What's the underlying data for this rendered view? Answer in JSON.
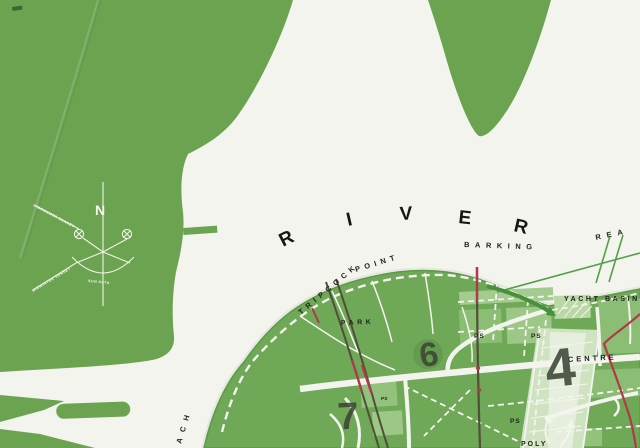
{
  "map_type": "planning-map-scan",
  "colors": {
    "land_green": "#6ba351",
    "land_green_south": "#6fa857",
    "paper_white": "#f3f4ee",
    "parcel_light": "#9cc583",
    "parcel_pale": "#cfe3c1",
    "parcel_palest": "#e6efdd",
    "route_dark_olive": "#514f39",
    "route_crimson": "#b03a4a",
    "route_green": "#55a04a",
    "label_ink": "#20251e",
    "compass_white": "#f6f8f0"
  },
  "river": {
    "letters": [
      "R",
      "I",
      "V",
      "E",
      "R"
    ],
    "reach_word": "BARKING",
    "reach_continuation": "REA",
    "left_reach_fragment": "ACH"
  },
  "shore": {
    "point_word1": "TRIPCOCK",
    "point_word2": "POINT"
  },
  "labels": {
    "park": "PARK",
    "yacht_basin": "YACHT BASIN",
    "centre": "CENTRE",
    "poly": "POLY",
    "ps_a": "PS",
    "ps_b": "PS",
    "ps_c": "PS",
    "ps_small": "PS"
  },
  "numbers": {
    "six": "6",
    "four": "4",
    "seven": "7"
  },
  "compass": {
    "north": "N",
    "upper_ray": "MIDSUMMER SUNSET",
    "lower_ray": "MIDWINTER SUNSET",
    "arc": "SUN PATH"
  }
}
